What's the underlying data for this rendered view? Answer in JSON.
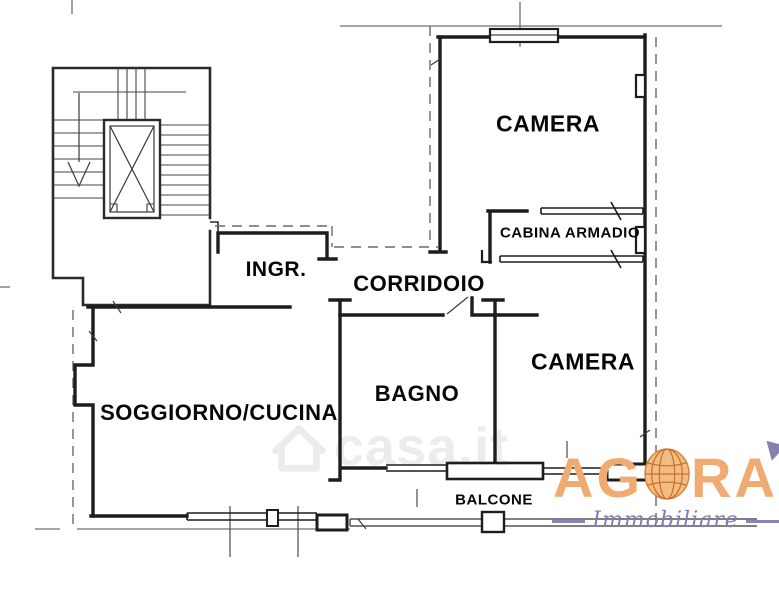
{
  "plan": {
    "rooms": [
      {
        "id": "camera-top",
        "label": "CAMERA"
      },
      {
        "id": "cabina-armadio",
        "label": "CABINA ARMADIO"
      },
      {
        "id": "ingresso",
        "label": "INGR."
      },
      {
        "id": "corridoio",
        "label": "CORRIDOIO"
      },
      {
        "id": "camera-right",
        "label": "CAMERA"
      },
      {
        "id": "bagno",
        "label": "BAGNO"
      },
      {
        "id": "soggiorno-cucina",
        "label": "SOGGIORNO/CUCINA"
      },
      {
        "id": "balcone",
        "label": "BALCONE"
      }
    ],
    "watermark_text": "casa.it",
    "wall_color": "#1d1d1d"
  },
  "logo": {
    "word_start": "AG",
    "word_end": "RA",
    "tagline": "Immobiliare",
    "orange": "#f0ab72",
    "purple": "#8a80b0"
  }
}
